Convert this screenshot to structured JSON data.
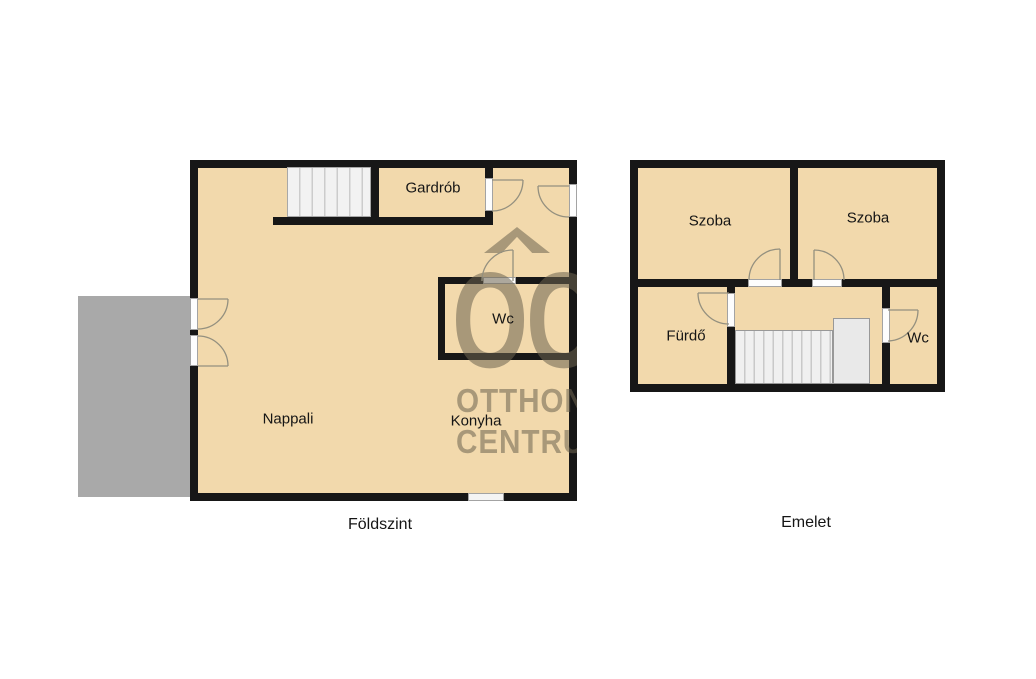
{
  "ground": {
    "caption": "Földszint",
    "rooms": [
      "Nappali",
      "Konyha",
      "Gardrób",
      "Wc"
    ]
  },
  "upper": {
    "caption": "Emelet",
    "rooms": [
      "Szoba",
      "Szoba",
      "Fürdő",
      "Wc"
    ]
  },
  "watermark": {
    "monogram": "OC",
    "line1": "OTTHON",
    "line2": "CENTRUM"
  },
  "colors": {
    "wall": "#171717",
    "room_fill": "#f2d9ac",
    "terrace_fill": "#a9a9a9",
    "stairs_fill": "#f2f2f2",
    "watermark": "#6d6450",
    "label_text": "#151515",
    "background": "#ffffff"
  }
}
